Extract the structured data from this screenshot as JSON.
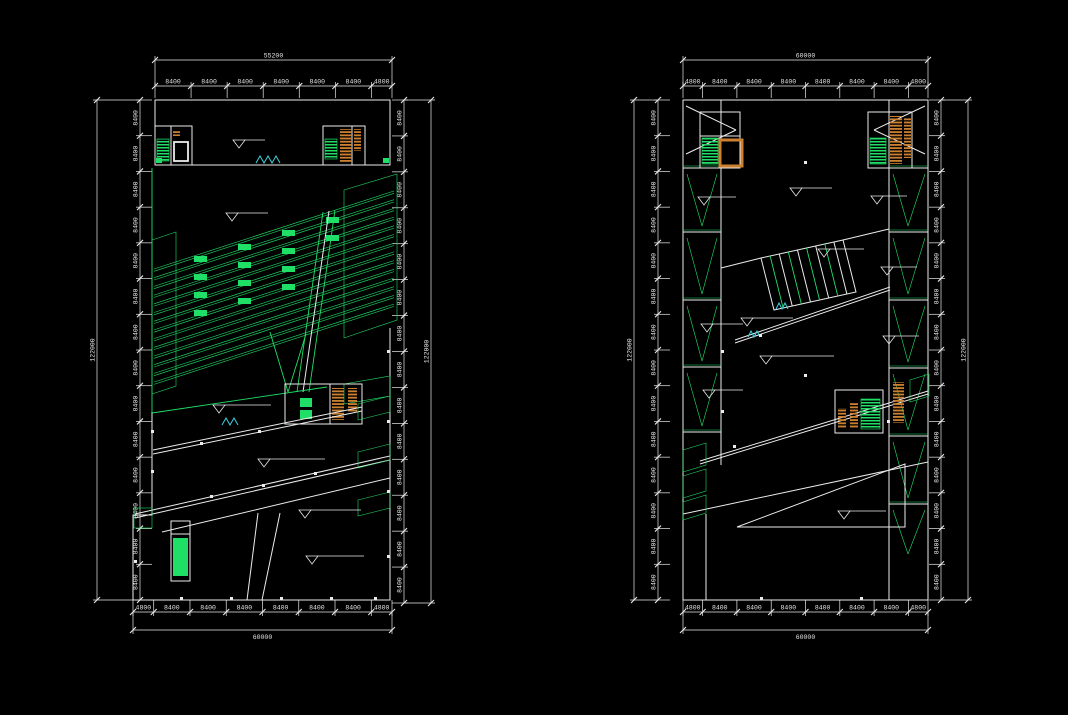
{
  "drawing": {
    "title": "two-floor-plans-cad-drawing",
    "colors": {
      "background": "#000000",
      "line": "#ebebeb",
      "text": "#e6e6e6",
      "green": "#1fdf66",
      "orange": "#cd8130",
      "cyan": "#3ed2de"
    }
  },
  "plans": [
    {
      "name": "left-plan",
      "dims": {
        "top_total": "55200",
        "top_segments": [
          "8400",
          "8400",
          "8400",
          "8400",
          "8400",
          "8400",
          "4800"
        ],
        "bottom_segments": [
          "4800",
          "8400",
          "8400",
          "8400",
          "8400",
          "8400",
          "8400",
          "4800"
        ],
        "bottom_total": "60000",
        "left_segments": [
          "8400",
          "8400",
          "8400",
          "8400",
          "8400",
          "8400",
          "8400",
          "8400",
          "8400",
          "8400",
          "8400",
          "8400",
          "8400",
          "8400"
        ],
        "left_total": "122000",
        "right_segments": [
          "8400",
          "8400",
          "8400",
          "8400",
          "8400",
          "8400",
          "8400",
          "8400",
          "8400",
          "8400",
          "8400",
          "8400",
          "8400",
          "8400"
        ],
        "right_total": "122000"
      }
    },
    {
      "name": "right-plan",
      "dims": {
        "top_total": "60000",
        "top_segments": [
          "4800",
          "8400",
          "8400",
          "8400",
          "8400",
          "8400",
          "8400",
          "4800"
        ],
        "bottom_segments": [
          "4800",
          "8400",
          "8400",
          "8400",
          "8400",
          "8400",
          "8400",
          "4800"
        ],
        "bottom_total": "60000",
        "left_segments": [
          "8400",
          "8400",
          "8400",
          "8400",
          "8400",
          "8400",
          "8400",
          "8400",
          "8400",
          "8400",
          "8400",
          "8400",
          "8400",
          "8400"
        ],
        "left_total": "122000",
        "right_segments": [
          "8400",
          "8400",
          "8400",
          "8400",
          "8400",
          "8400",
          "8400",
          "8400",
          "8400",
          "8400",
          "8400",
          "8400",
          "8400",
          "8400"
        ],
        "right_total": "122000"
      }
    }
  ]
}
